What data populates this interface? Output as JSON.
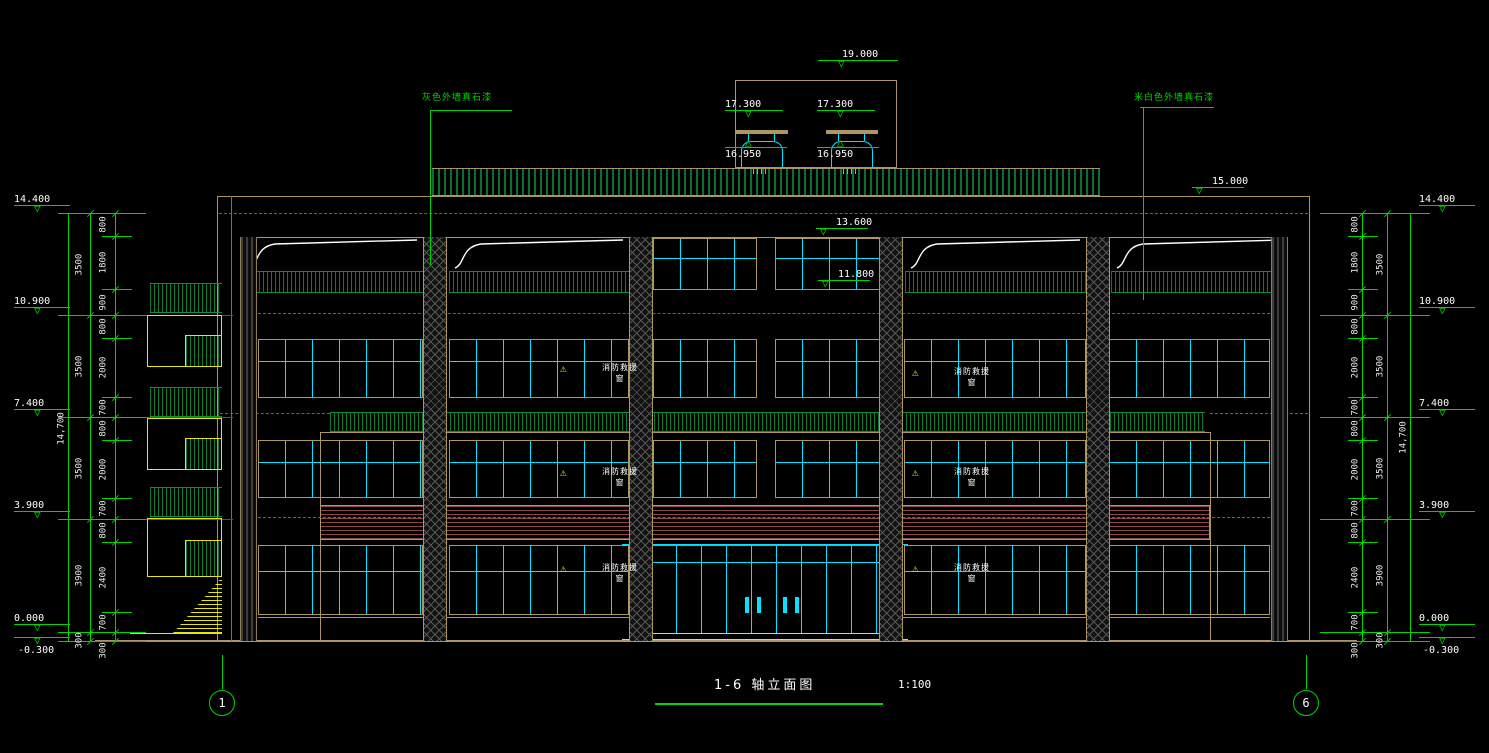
{
  "colors": {
    "background": "#000000",
    "dimension_green": "#00d400",
    "frame_tan": "#ad9660",
    "glazing_cyan": "#00e5ff",
    "detail_yellow": "#e8e800",
    "railing_green": "#0c6e2f",
    "louver_maroon": "#8a4a4a",
    "text_white": "#ffffff",
    "warning_yellow": "#ffdd00"
  },
  "title": {
    "text": "1-6 轴立面图",
    "scale": "1:100"
  },
  "axis_bubbles": {
    "left": "1",
    "right": "6"
  },
  "material_labels": {
    "left": "灰色外墙真石漆",
    "right": "米白色外墙真石漆"
  },
  "rescue_window_label": "消防救援窗",
  "warning_symbol": "⚠",
  "triangle_down": "▽",
  "triangle_up": "△",
  "elevations": [
    "14.400",
    "10.900",
    "7.400",
    "3.900",
    "0.000",
    "-0.300"
  ],
  "top_elevations": {
    "roof_access": "19.000",
    "vent_cap": "17.300",
    "vent_top": "16.950",
    "parapet": "15.000",
    "band_top": "13.600",
    "window_sill": "11.800"
  },
  "dims": {
    "sub": [
      "800",
      "1800",
      "900",
      "800",
      "2000",
      "700",
      "800",
      "2000",
      "700",
      "800",
      "2400",
      "700",
      "300"
    ],
    "mid": [
      "3500",
      "3500",
      "3500",
      "3900",
      "300"
    ],
    "total": "14,700"
  }
}
